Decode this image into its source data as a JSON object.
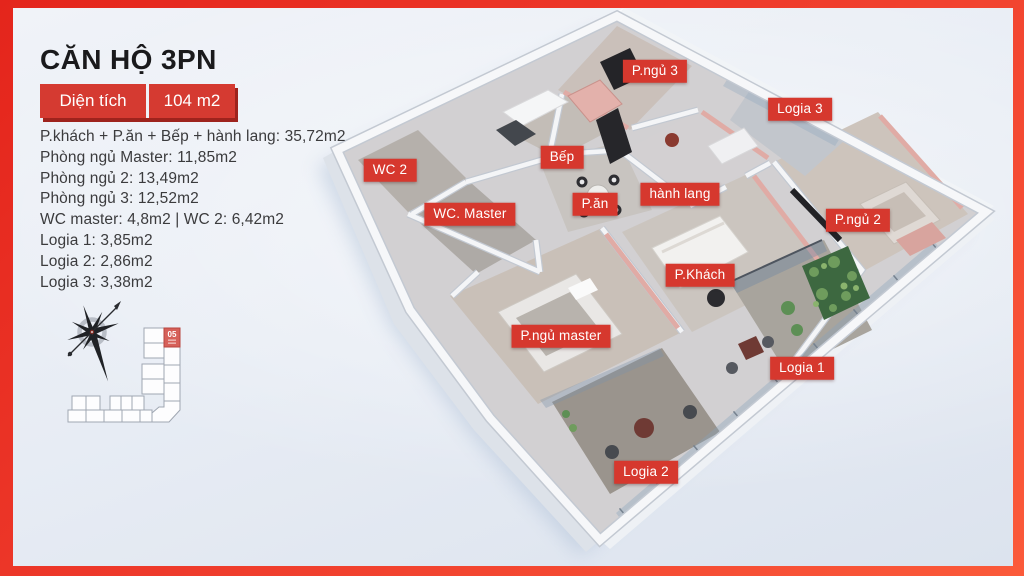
{
  "header": {
    "title": "CĂN HỘ 3PN",
    "area_label": "Diện tích",
    "area_value": "104 m2"
  },
  "room_list": [
    "P.khách + P.ăn + Bếp + hành lang: 35,72m2",
    "Phòng ngủ Master: 11,85m2",
    "Phòng ngủ 2: 13,49m2",
    "Phòng ngủ 3: 12,52m2",
    "WC master: 4,8m2 | WC 2: 6,42m2",
    "Logia 1: 3,85m2",
    "Logia 2: 2,86m2",
    "Logia 3: 3,38m2"
  ],
  "key_plan": {
    "highlighted_unit": "05"
  },
  "floorplan_labels": [
    {
      "id": "wc-2",
      "text": "WC 2",
      "x": 390,
      "y": 170
    },
    {
      "id": "wc-master",
      "text": "WC. Master",
      "x": 470,
      "y": 214
    },
    {
      "id": "bep",
      "text": "Bếp",
      "x": 562,
      "y": 157
    },
    {
      "id": "p-an",
      "text": "P.ăn",
      "x": 595,
      "y": 204
    },
    {
      "id": "hanh-lang",
      "text": "hành lang",
      "x": 680,
      "y": 194
    },
    {
      "id": "p-ngu-3",
      "text": "P.ngủ 3",
      "x": 655,
      "y": 71
    },
    {
      "id": "logia-3",
      "text": "Logia 3",
      "x": 800,
      "y": 109
    },
    {
      "id": "p-ngu-2",
      "text": "P.ngủ 2",
      "x": 858,
      "y": 220
    },
    {
      "id": "p-khach",
      "text": "P.Khách",
      "x": 700,
      "y": 275
    },
    {
      "id": "p-ngu-master",
      "text": "P.ngủ master",
      "x": 561,
      "y": 336
    },
    {
      "id": "logia-1",
      "text": "Logia 1",
      "x": 802,
      "y": 368
    },
    {
      "id": "logia-2",
      "text": "Logia 2",
      "x": 646,
      "y": 472
    }
  ],
  "colors": {
    "accent_red": "#d6382e",
    "frame_red_dark": "#e4251c",
    "frame_red_light": "#fb5a3a",
    "background": "#e9eef5",
    "title_text": "#1a1a1c",
    "body_text": "#3b3b3d",
    "pink_wall": "#e0aba5"
  }
}
